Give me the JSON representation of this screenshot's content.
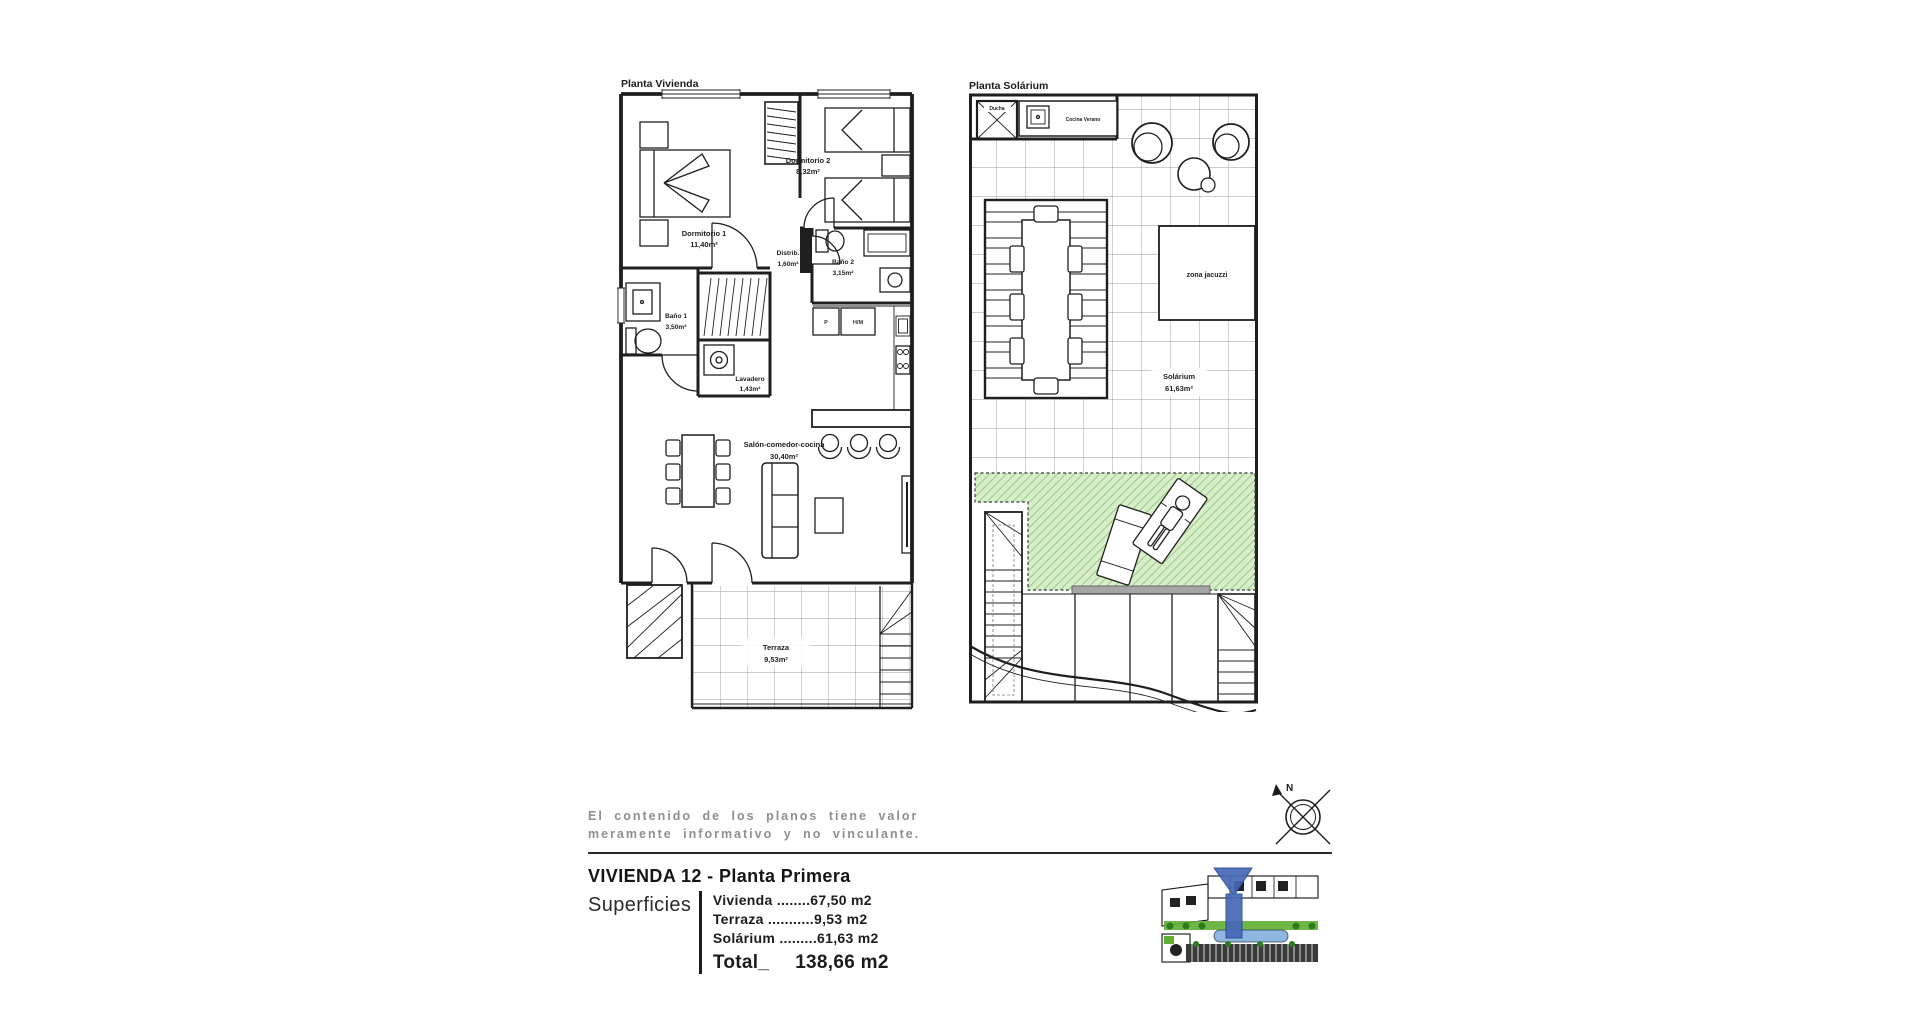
{
  "plan_vivienda": {
    "title": "Planta Vivienda",
    "rooms": {
      "dormitorio1": {
        "name": "Dormitorio 1",
        "area": "11,40m²"
      },
      "dormitorio2": {
        "name": "Dormitorio 2",
        "area": "8,32m²"
      },
      "distrib": {
        "name": "Distrib.",
        "area": "1,60m²"
      },
      "bano1": {
        "name": "Baño 1",
        "area": "3,50m²"
      },
      "bano2": {
        "name": "Baño 2",
        "area": "3,15m²"
      },
      "lavadero": {
        "name": "Lavadero",
        "area": "1,43m²"
      },
      "salon": {
        "name": "Salón-comedor-cocina",
        "area": "30,40m²"
      },
      "terraza": {
        "name": "Terraza",
        "area": "9,53m²"
      }
    },
    "appliance_labels": {
      "p": "P",
      "hm": "H/M"
    }
  },
  "plan_solarium": {
    "title": "Planta Solárium",
    "labels": {
      "ducha": "Ducha",
      "cocina_verano": "Cocina Verano",
      "zona_jacuzzi": "zona jacuzzi",
      "solarium_name": "Solárium",
      "solarium_area": "61,63m²"
    }
  },
  "compass": {
    "north": "N"
  },
  "footer": {
    "disclaimer_line1": "El contenido de los planos tiene valor",
    "disclaimer_line2": "meramente informativo y no vinculante.",
    "heading": "VIVIENDA 12 - Planta Primera",
    "superficies_label": "Superficies",
    "rows": [
      "Vivienda ........67,50 m2",
      "Terraza ...........9,53 m2",
      "Solárium .........61,63 m2"
    ],
    "total_label": "Total_",
    "total_value": "138,66 m2"
  },
  "colors": {
    "line": "#1f1f1f",
    "tile_grid": "#9a9a9a",
    "green_fill": "#d8eecb",
    "green_hatch": "#96cd80",
    "gray_text": "#8f8f8f",
    "marker_blue": "#4668b8",
    "pool_blue": "#8fb6e0",
    "map_green": "#5fae33"
  }
}
